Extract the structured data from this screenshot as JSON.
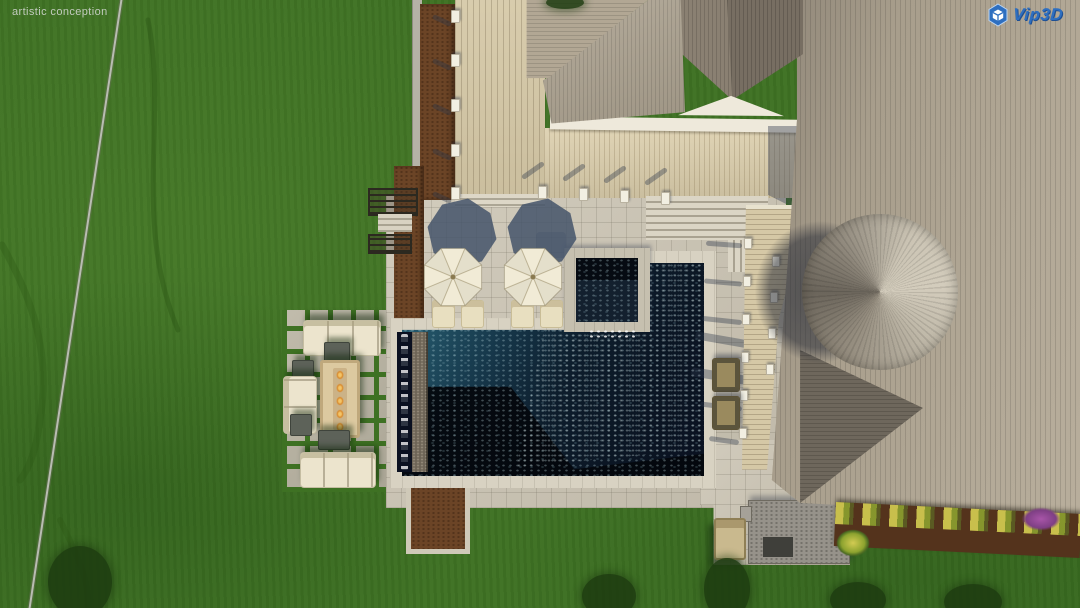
{
  "watermark": {
    "text": "artistic conception"
  },
  "logo": {
    "text": "Vip3D",
    "icon": "vip3d-hexagon-cube-icon"
  },
  "colors": {
    "grass": "#3e7123",
    "tree-shadow": "#1d3b10",
    "paver": "#cbc4b3",
    "coping": "#d8d2c2",
    "deck": "#d5c8a6",
    "wall": "#dccfad",
    "fascia": "#eee9db",
    "roof": "#a89d8b",
    "roof-dark": "#6e675c",
    "gable-left": "#8a8072",
    "gable-right": "#776e62",
    "cone-light": "#d3ccbc",
    "cone-dark": "#6b655b",
    "pool-teal": "#2d6476",
    "pool-navy": "#0b1624",
    "pool-deep": "#04070d",
    "water-trough": "#0a1020",
    "stone-wall": "#6e6557",
    "umbrella": "#f1ebd6",
    "umbrella-shadow": "#44546a",
    "dirt": "#6b4426",
    "dirt-dark": "#54331c",
    "cream": "#ece4cd",
    "fire-table": "#dcc9a0",
    "flame": "#d88a2e",
    "cube-gray": "#5d6259",
    "kitchen": "#96928a",
    "flower-yellow": "#d2cb52",
    "flower-green": "#8da32f",
    "flower-purple": "#a855a8",
    "olive": "#9a8a5e",
    "watermark": "#cdd3cb",
    "logo-blue": "#2e6fc0",
    "logo-deep": "#1d4f94"
  }
}
